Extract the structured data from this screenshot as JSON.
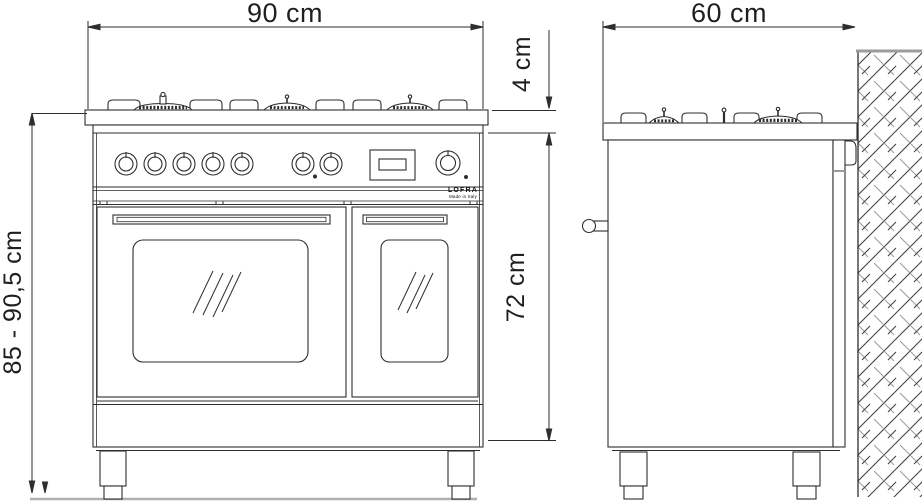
{
  "drawing": {
    "description": "Dimensional line drawing of a 90 cm range cooker, front view and side view against a hatched wall section",
    "dimensions": {
      "front_width": "90 cm",
      "side_depth": "60 cm",
      "hob_profile_height": "4 cm",
      "body_height": "72 cm",
      "overall_height": "85 - 90,5 cm"
    },
    "brand": {
      "name": "LOFRA",
      "tagline": "Made in Italy"
    },
    "features": {
      "front_burner_groups": 3,
      "side_burner_groups": 2,
      "control_knobs": 8,
      "oven_doors": 2
    },
    "colors": {
      "line": "#2e2e2e",
      "muted_gray": "#9b9b9b",
      "floor_gray": "#b0b0b0",
      "background": "#ffffff"
    }
  }
}
